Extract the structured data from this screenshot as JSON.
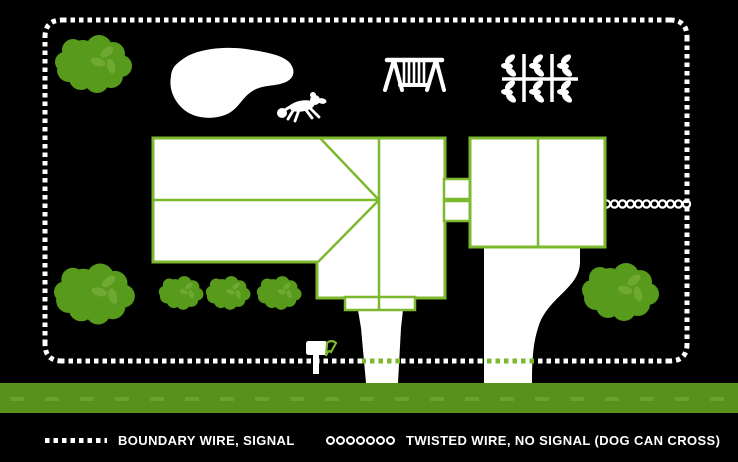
{
  "colors": {
    "background": "#000000",
    "white": "#ffffff",
    "tree_green": "#589a1b",
    "leaf_green": "#6fa933",
    "outline_green": "#7cb92f",
    "road_green": "#58911c",
    "road_dash_green": "#6aa32a"
  },
  "legend": {
    "boundary": {
      "swatch_icon": "dotted-line-icon",
      "label": "BOUNDARY WIRE, SIGNAL"
    },
    "twisted": {
      "swatch_icon": "twisted-rings-icon",
      "label": "TWISTED WIRE, NO SIGNAL (DOG CAN CROSS)"
    }
  },
  "scene": {
    "elements": [
      "boundary-wire",
      "twisted-wire",
      "house",
      "garage",
      "breezeway",
      "porch",
      "front-walkway",
      "garage-driveway",
      "road",
      "pond",
      "dog",
      "mailbox",
      "swing-set",
      "garden",
      "trees"
    ]
  }
}
